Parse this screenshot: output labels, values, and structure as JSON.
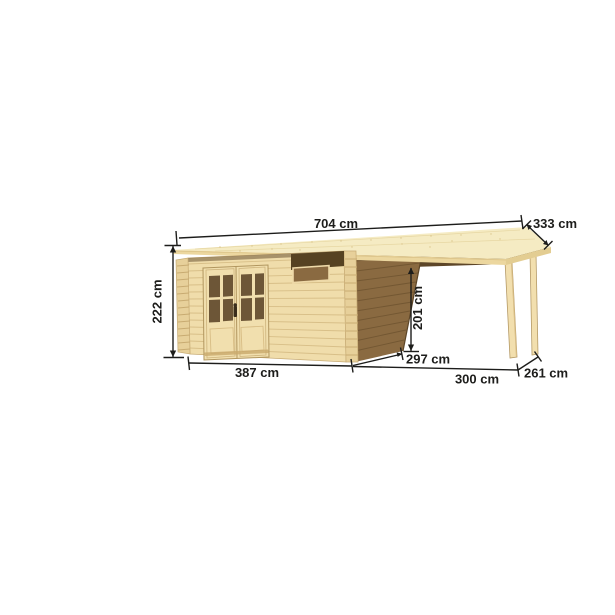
{
  "illustration": {
    "description": "Wooden flat-roof garden shed with double door, slit window and side canopy extension, shown as dimensioned product drawing",
    "colors": {
      "background": "#ffffff",
      "roof_top": "#f5ebc3",
      "roof_edge_front": "#ecd79f",
      "roof_edge_side": "#e3cd92",
      "roof_underside": "#5d4628",
      "wall_front": "#f0ddab",
      "wall_corner_logs": "#e7d09a",
      "wall_side_shadow": "#8a6a41",
      "door_frame": "#f1dfae",
      "door_glass": "#6d5637",
      "window_slit": "#564222",
      "window_pane_open": "#8a6a41",
      "post_wood": "#f2dfae",
      "dimension_line": "#1d1d1b",
      "label_text": "#1d1d1b"
    },
    "dimensions": {
      "roof_width": "704 cm",
      "roof_depth": "333 cm",
      "wall_height": "222 cm",
      "canopy_clearance_height": "201 cm",
      "shed_width": "387 cm",
      "shed_depth": "297 cm",
      "canopy_width": "300 cm",
      "canopy_depth": "261 cm"
    }
  }
}
